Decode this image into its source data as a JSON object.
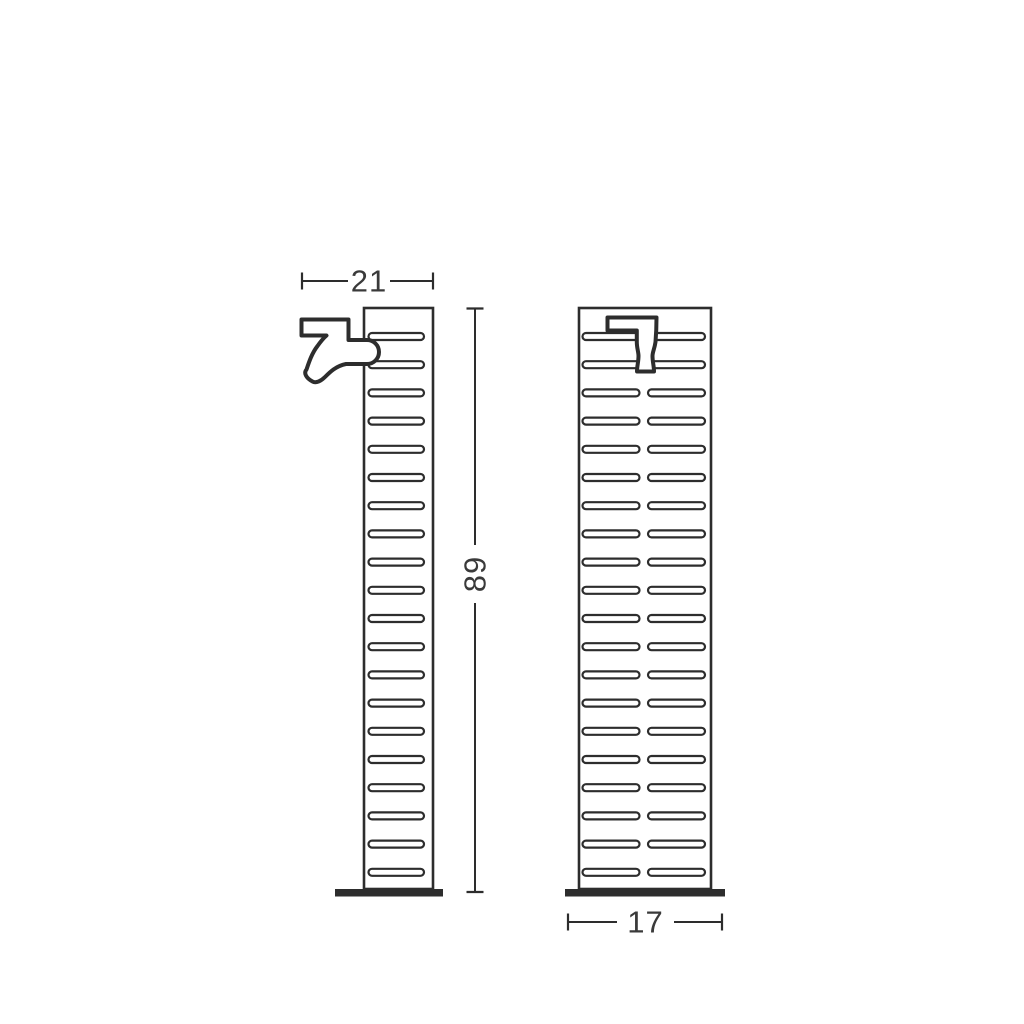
{
  "drawing": {
    "description": "technical-dimension-drawing-garden-fountain-column",
    "background_color": "#ffffff",
    "stroke_color": "#2d2d2d",
    "fill_color": "#ffffff",
    "text_color": "#3a3a3a",
    "views": {
      "side": {
        "name": "side-view",
        "column": {
          "x": 364,
          "y": 308,
          "width": 69,
          "height": 581
        },
        "slats": {
          "x": 368.5,
          "width": 55.5,
          "height": 7,
          "first_center_y": 336.5,
          "spacing": 28.2,
          "count": 20
        },
        "base": {
          "x": 335,
          "y": 889,
          "width": 108,
          "height": 7.5
        }
      },
      "front": {
        "name": "front-view",
        "column": {
          "x": 579,
          "y": 308,
          "width": 132,
          "height": 581
        },
        "rows": {
          "first_center_y": 336.5,
          "spacing": 28.2,
          "count": 20,
          "full_width_rows": 2
        },
        "full_slat": {
          "x": 582.5,
          "width": 122.5,
          "height": 7
        },
        "paired_slat": {
          "left_x": 582.5,
          "right_x": 648,
          "width": 57,
          "height": 7
        },
        "base": {
          "x": 565,
          "y": 889,
          "width": 160,
          "height": 7.5
        }
      }
    },
    "dimensions": [
      {
        "id": "depth-top",
        "label": "21",
        "orientation": "horizontal",
        "x1": 302,
        "x2": 433,
        "y": 281,
        "gap_start": 348,
        "gap_end": 390
      },
      {
        "id": "height-right",
        "label": "89",
        "orientation": "vertical",
        "y1": 308.5,
        "y2": 892,
        "x": 475,
        "gap_start": 545,
        "gap_end": 603
      },
      {
        "id": "width-bottom",
        "label": "17",
        "orientation": "horizontal",
        "x1": 568,
        "x2": 722,
        "y": 922,
        "gap_start": 617,
        "gap_end": 674
      }
    ]
  }
}
